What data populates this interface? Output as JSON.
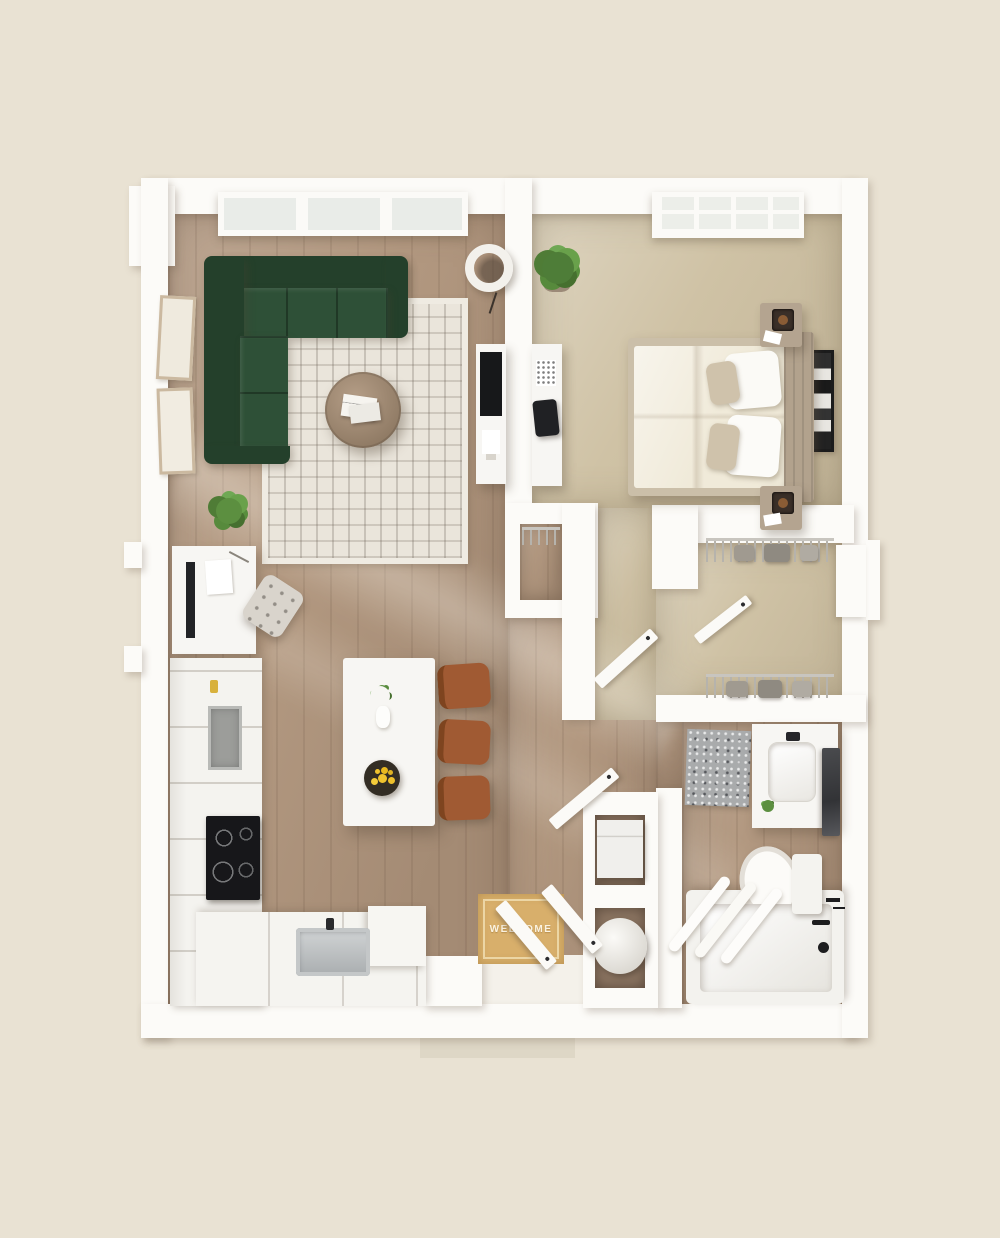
{
  "scene": {
    "title": "apartment-floor-plan-3d-render",
    "welcome_mat_text": "WELCOME"
  },
  "colors": {
    "background": "#e9e2d3",
    "wall": "#fcfbf8",
    "wood_floor": "#b29880",
    "carpet": "#cfc2a5",
    "rug": "#eae5db",
    "sofa_green": "#2e5037",
    "sofa_green_dark": "#24402b",
    "coffee_table": "#a18b74",
    "island_white": "#f7f6f3",
    "dining_chair_rust": "#a05a33",
    "lemon_yellow": "#f0c32e",
    "plant_green": "#5c8f40",
    "welcome_mat": "#d8af6b",
    "bath_mat_gray": "#a9abac",
    "cooktop_black": "#17171a",
    "sink_steel": "#b9bcbe",
    "headboard_taupe": "#b2a28d",
    "duvet_cream": "#f0ead9"
  },
  "rooms": [
    {
      "id": "living-room",
      "floor": "hardwood"
    },
    {
      "id": "kitchen",
      "floor": "hardwood"
    },
    {
      "id": "bedroom",
      "floor": "carpet"
    },
    {
      "id": "walk-in-closet",
      "floor": "carpet"
    },
    {
      "id": "bathroom",
      "floor": "hardwood"
    },
    {
      "id": "entry-hall",
      "floor": "hardwood"
    }
  ],
  "furniture": {
    "living_room": [
      "sectional-sofa-green",
      "geometric-area-rug",
      "round-coffee-table",
      "magazines",
      "papasan-chair",
      "potted-plant",
      "two-wall-frames",
      "tv-console",
      "window-bank"
    ],
    "bedroom": [
      "bed-with-upholstered-headboard",
      "nightstand-with-lamp-north",
      "nightstand-with-lamp-south",
      "gallery-wall-art",
      "potted-plant",
      "desk-with-black-chair",
      "gridded-window"
    ],
    "kitchen": [
      "white-island-with-flower-vase-and-lemon-bowl",
      "three-rust-dining-chairs",
      "cooktop-with-burners",
      "wall-oven",
      "tall-cabinets",
      "stainless-sink",
      "l-shaped-counter",
      "built-in-desk-nook",
      "tufted-stool"
    ],
    "bathroom": [
      "vanity-with-sink",
      "wall-mirror",
      "toilet",
      "bathtub-with-black-fixtures",
      "speckled-bath-mat",
      "rolled-towels"
    ],
    "walk_in_closet": [
      "wire-shelf-hanging-clothes-top",
      "wire-shelf-hanging-clothes-bottom",
      "shelf-unit"
    ],
    "entry": [
      "welcome-mat",
      "double-entry-doors"
    ],
    "utility": [
      "stacked-washer-cube",
      "water-heater-cylinder"
    ],
    "hall": [
      "coat-closet-with-hangers",
      "bedroom-door",
      "closet-door",
      "bathroom-door"
    ]
  }
}
